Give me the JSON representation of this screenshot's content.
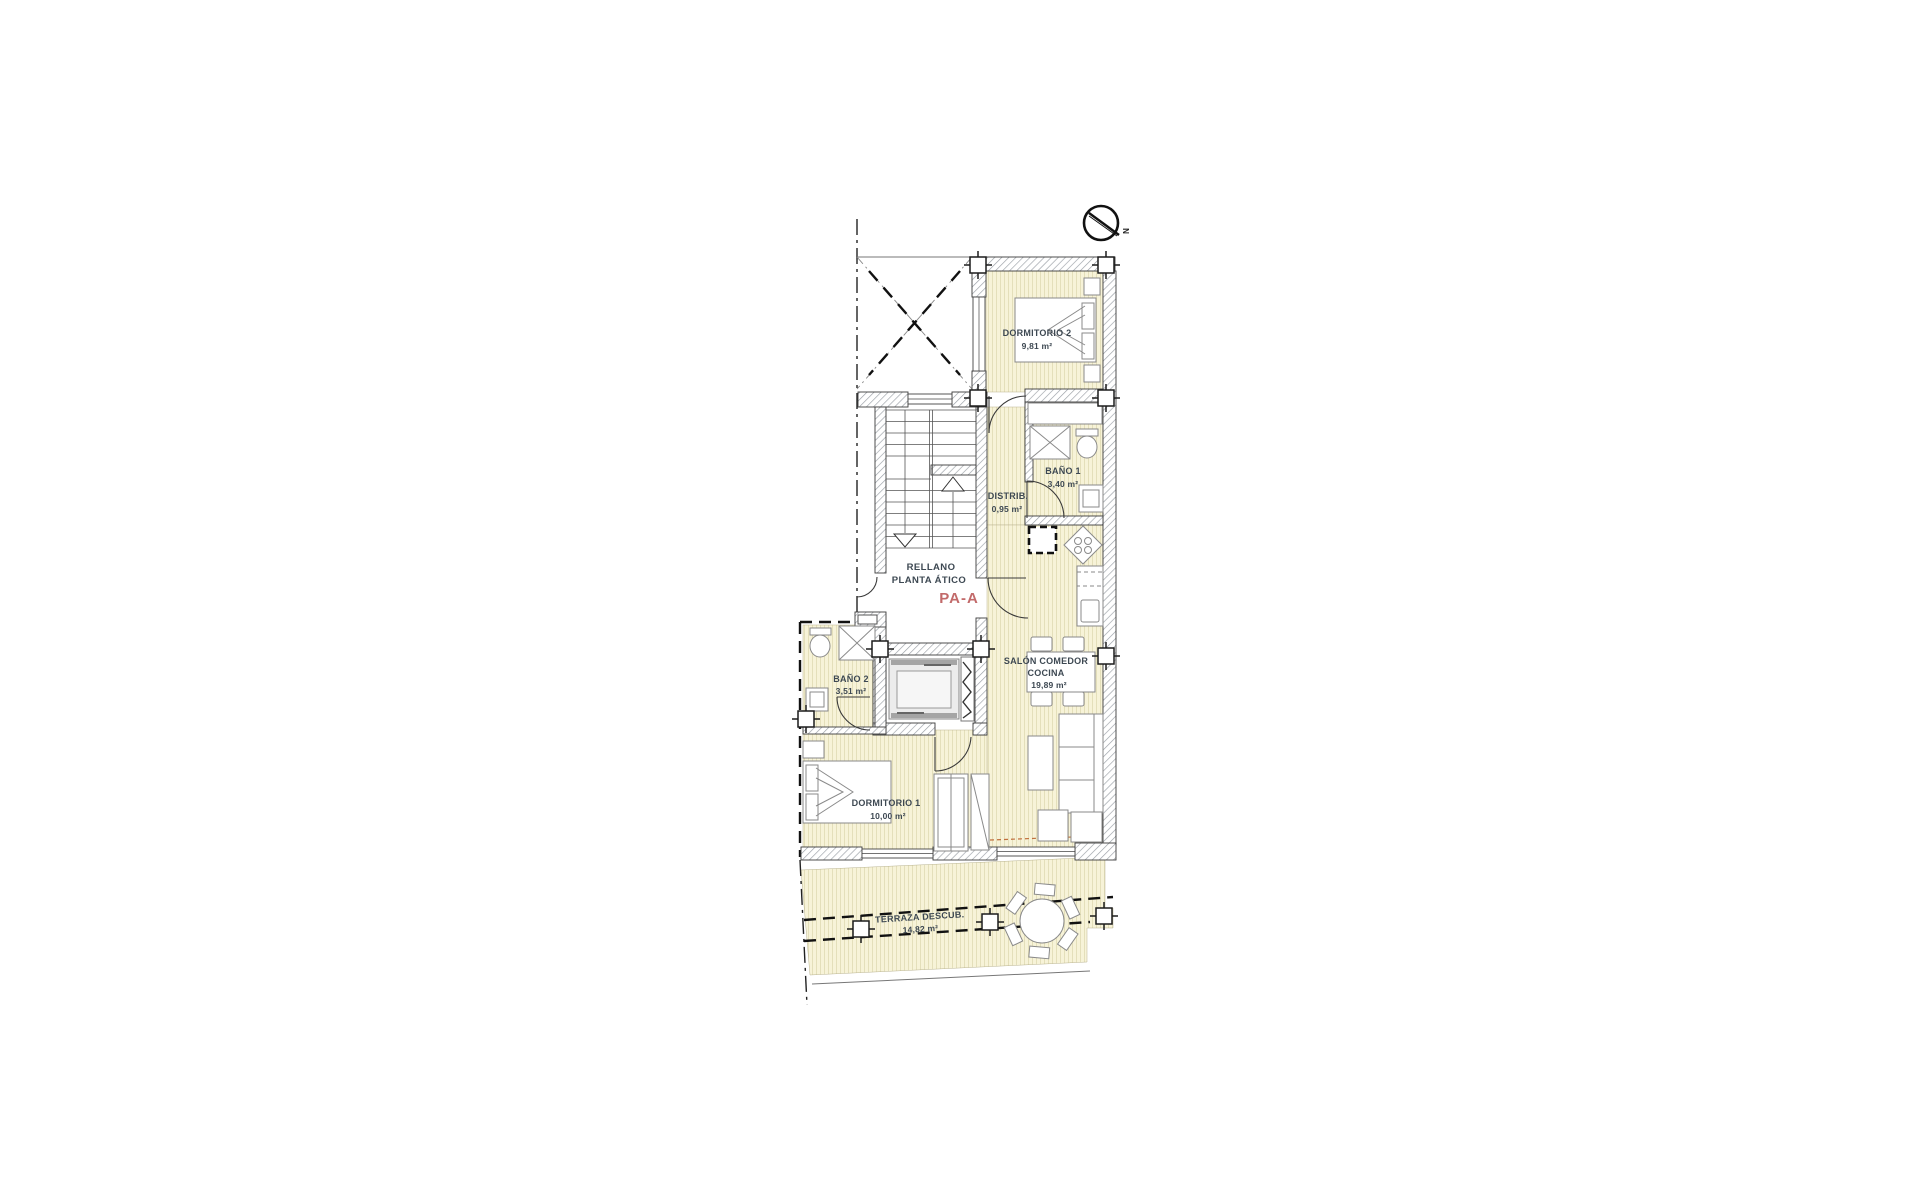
{
  "plan": {
    "landing": {
      "line1": "RELLANO",
      "line2": "PLANTA ÁTICO",
      "code": "PA-A"
    },
    "compass": {
      "letter": "N"
    },
    "rooms": {
      "dormitorio2": {
        "name": "DORMITORIO 2",
        "area": "9,81 m²"
      },
      "bano1": {
        "name": "BAÑO 1",
        "area": "3,40 m²"
      },
      "distrib": {
        "name": "DISTRIB.",
        "area": "0,95 m²"
      },
      "bano2": {
        "name": "BAÑO 2",
        "area": "3,51  m²"
      },
      "salon": {
        "line1": "SALÓN COMEDOR",
        "line2": "COCINA",
        "area": "19,89 m²"
      },
      "dormitorio1": {
        "name": "DORMITORIO 1",
        "area": "10,00 m²"
      },
      "terraza": {
        "name": "TERRAZA DESCUB.",
        "area": "14,82 m²"
      }
    },
    "colors": {
      "floor_fill": "#f7f3d8",
      "floor_stripe": "#e4dfba",
      "label_text": "#3d4852",
      "code_red": "#c26a6a",
      "wall_hatch": "#9aa0a6"
    }
  }
}
